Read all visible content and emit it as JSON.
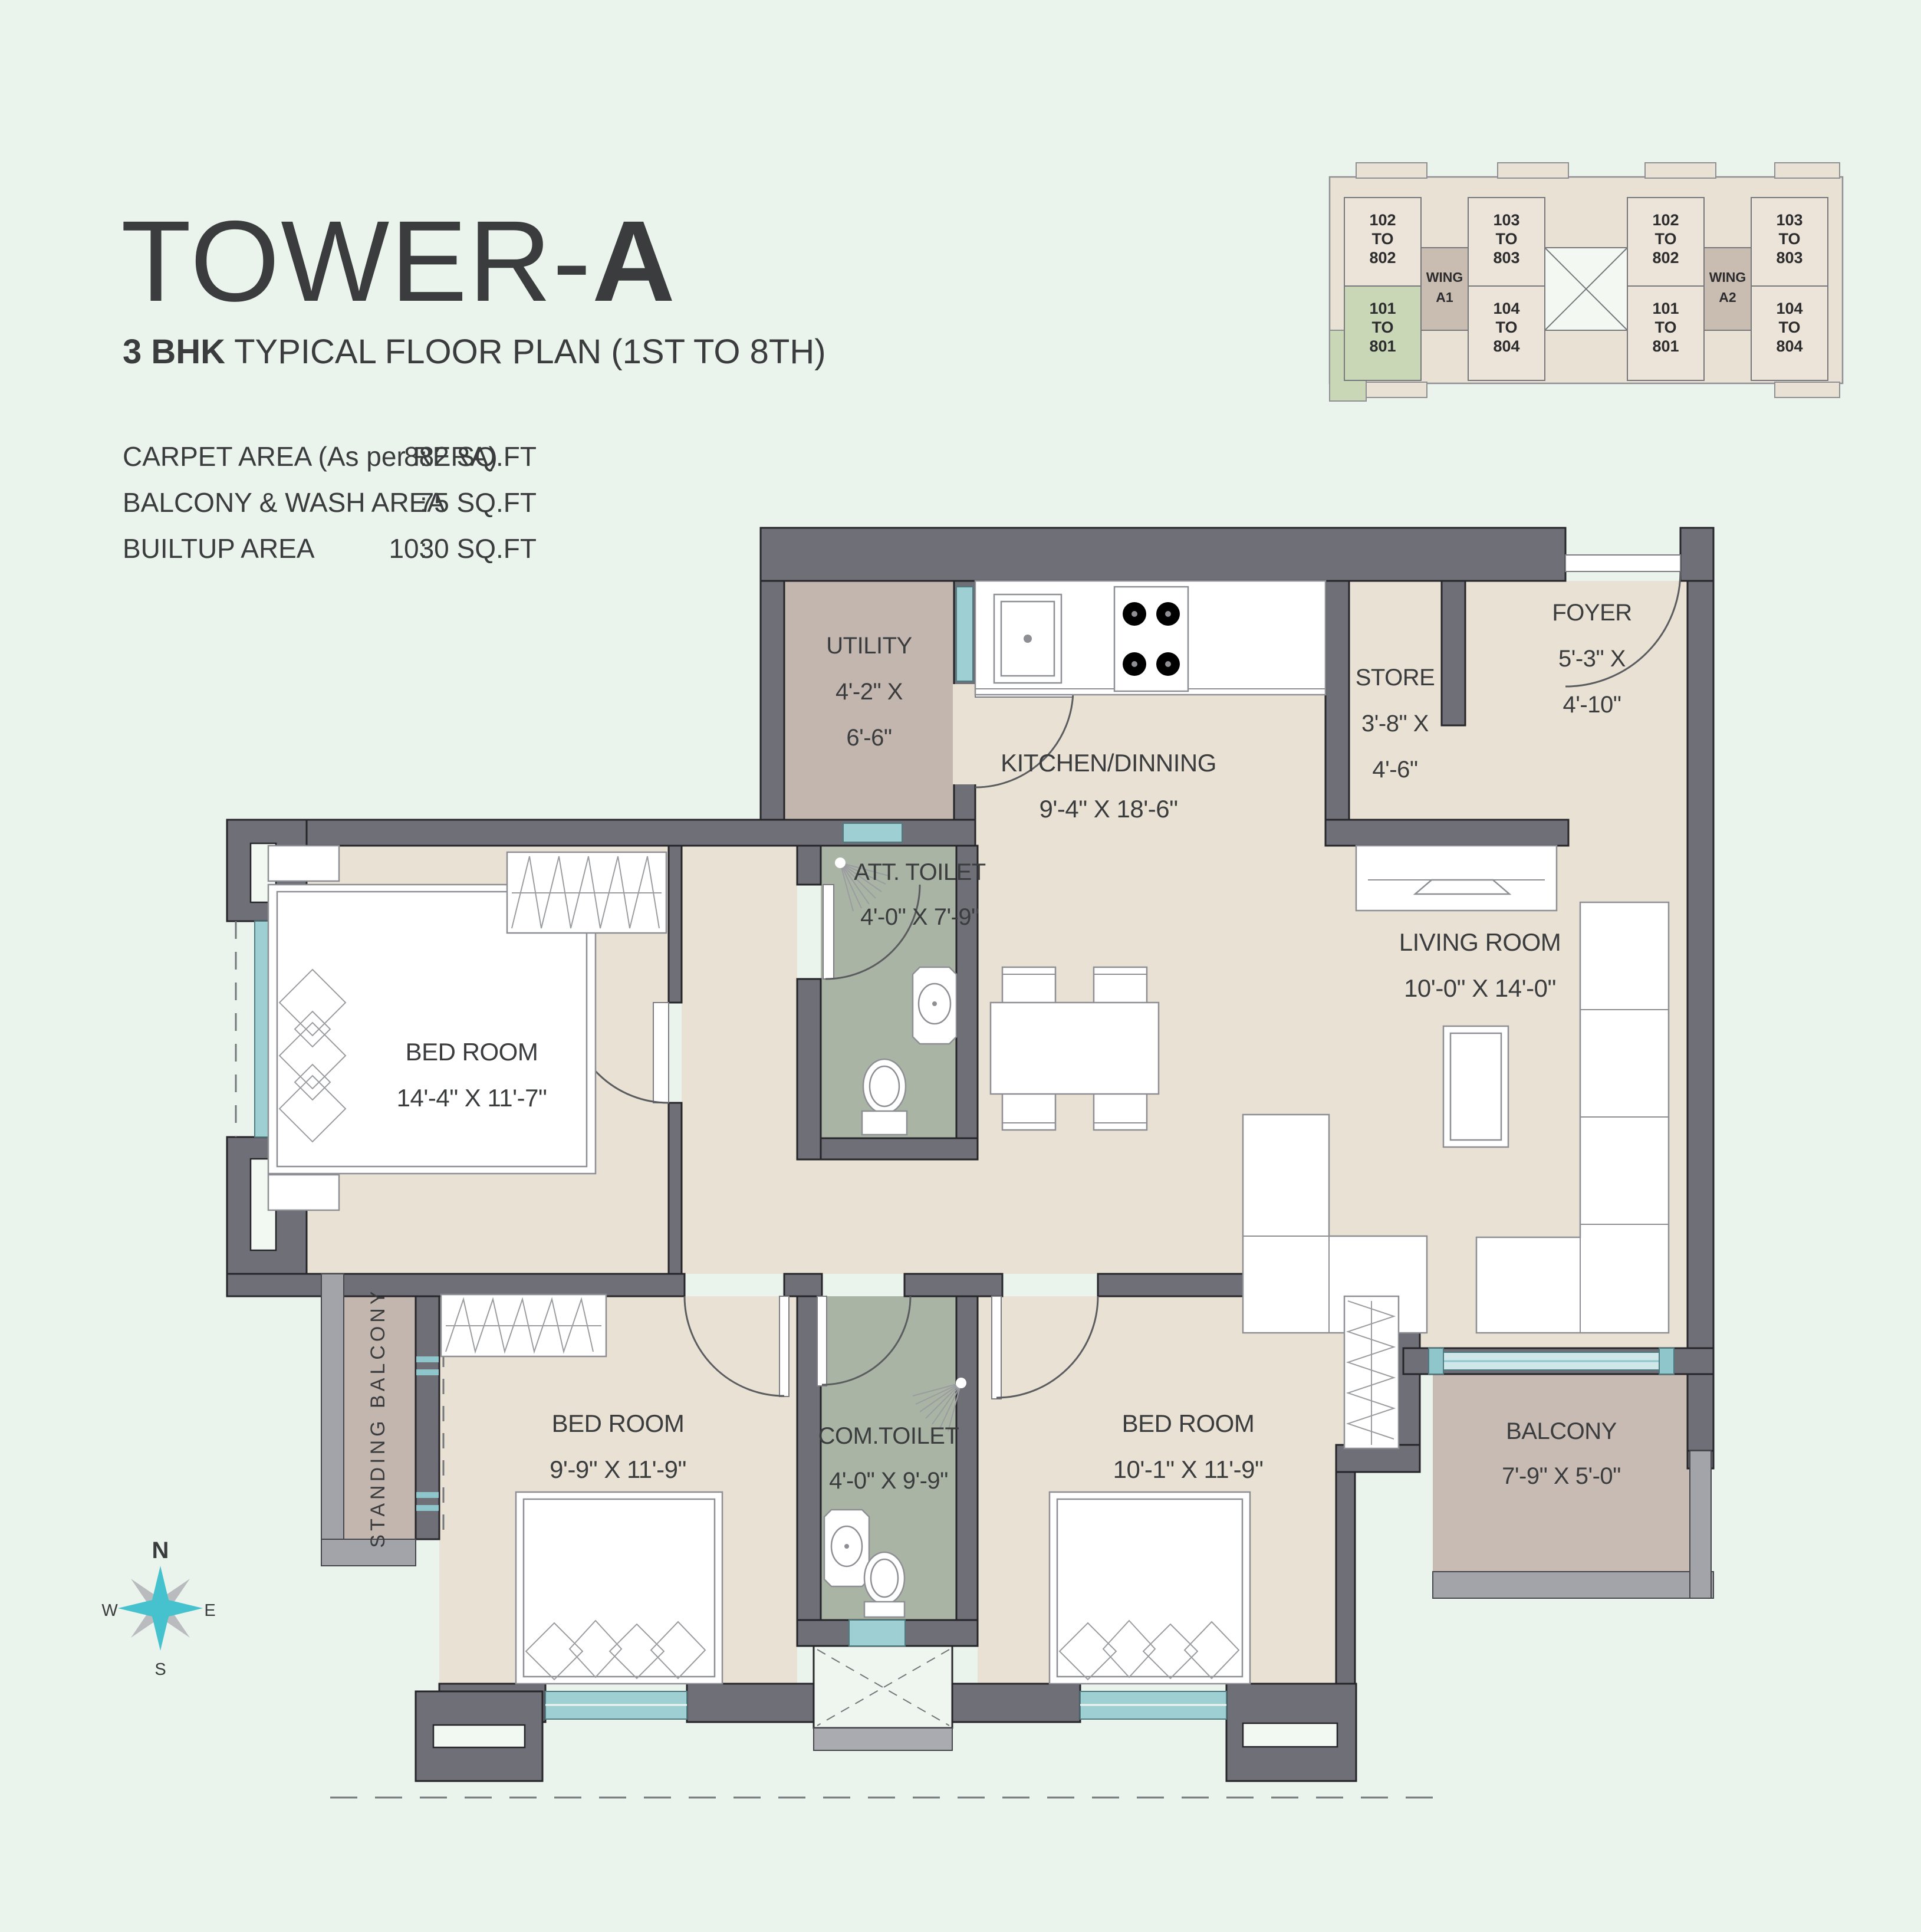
{
  "title": {
    "main": "TOWER-",
    "suffix": "A",
    "subtitle_bold": "3 BHK",
    "subtitle_rest": " TYPICAL FLOOR PLAN (1ST TO 8TH)"
  },
  "areas": {
    "separator": ":",
    "rows": [
      {
        "label": "CARPET AREA (As per RERA)",
        "value": "882 SQ.FT"
      },
      {
        "label": "BALCONY & WASH AREA",
        "value": "75 SQ.FT"
      },
      {
        "label": "BUILTUP AREA",
        "value": "1030 SQ.FT"
      }
    ]
  },
  "rooms": {
    "utility": {
      "name": "UTILITY",
      "dim1": "4'-2\" X",
      "dim2": "6'-6\""
    },
    "kitchen": {
      "name": "KITCHEN/DINNING",
      "dim": "9'-4\" X 18'-6\""
    },
    "store": {
      "name": "STORE",
      "dim1": "3'-8\" X",
      "dim2": "4'-6\""
    },
    "foyer": {
      "name": "FOYER",
      "dim1": "5'-3\" X",
      "dim2": "4'-10\""
    },
    "att_toilet": {
      "name": "ATT. TOILET",
      "dim": "4'-0\" X 7'-9\""
    },
    "bedroom_master": {
      "name": "BED ROOM",
      "dim": "14'-4\" X 11'-7\""
    },
    "living": {
      "name": "LIVING ROOM",
      "dim": "10'-0\" X 14'-0\""
    },
    "bedroom_left": {
      "name": "BED ROOM",
      "dim": "9'-9\" X 11'-9\""
    },
    "com_toilet": {
      "name": "COM.TOILET",
      "dim": "4'-0\" X 9'-9\""
    },
    "bedroom_right": {
      "name": "BED ROOM",
      "dim": "10'-1\" X 11'-9\""
    },
    "balcony": {
      "name": "BALCONY",
      "dim": "7'-9\" X 5'-0\""
    },
    "standing_balcony": {
      "name": "STANDING  BALCONY"
    }
  },
  "key_plan": {
    "columns": [
      {
        "top": [
          "102",
          "TO",
          "802"
        ],
        "bottom": [
          "101",
          "TO",
          "801"
        ],
        "bottom_highlight": true
      },
      {
        "top": [
          "103",
          "TO",
          "803"
        ],
        "bottom": [
          "104",
          "TO",
          "804"
        ],
        "bottom_highlight": false
      },
      {
        "top": [
          "102",
          "TO",
          "802"
        ],
        "bottom": [
          "101",
          "TO",
          "801"
        ],
        "bottom_highlight": false
      },
      {
        "top": [
          "103",
          "TO",
          "803"
        ],
        "bottom": [
          "104",
          "TO",
          "804"
        ],
        "bottom_highlight": false
      }
    ],
    "wings": [
      [
        "WING",
        "A1"
      ],
      [
        "WING",
        "A2"
      ]
    ]
  },
  "compass": {
    "n": "N",
    "e": "E",
    "s": "S",
    "w": "W"
  },
  "colors": {
    "background": "#ebf4ec",
    "wall": "#6e6f77",
    "floor_beige": "#e9e1d3",
    "floor_mauve": "#c3b6ae",
    "floor_balcony": "#c7bbb3",
    "floor_toilet": "#aab4a4",
    "window_teal": "#9ecfd3",
    "key_highlight_green": "#c9d7b6",
    "key_wing_brown": "#c9bcb1",
    "compass_teal": "#45c2cd",
    "title_text": "#5d6266"
  }
}
